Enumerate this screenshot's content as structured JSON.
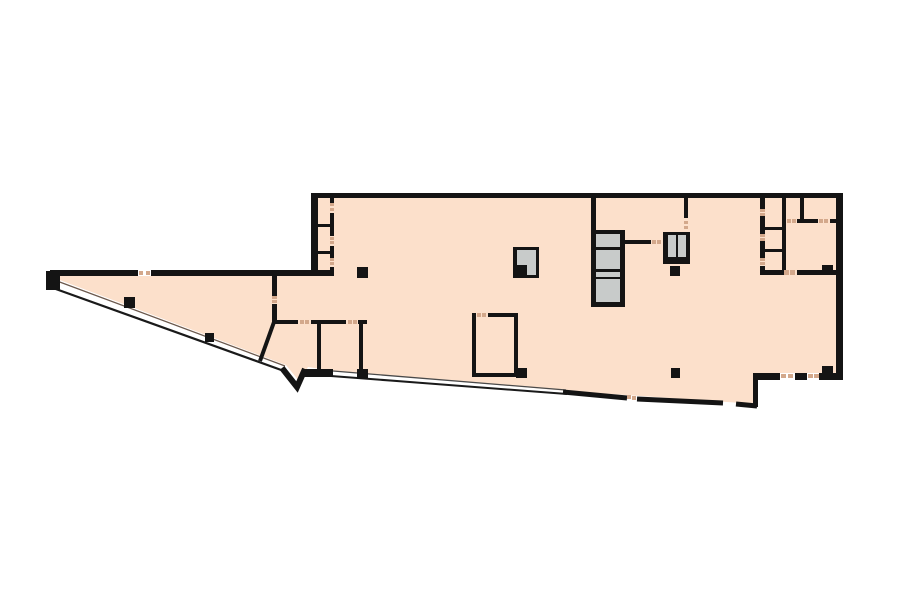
{
  "plan": {
    "view": {
      "w": 900,
      "h": 604,
      "bg": "#ffffff"
    },
    "palette": {
      "floor": "#fce0cb",
      "wall": "#141414",
      "shaft": "#c8cbca",
      "white": "#ffffff",
      "tick": "#d3a88b",
      "inner": "#6b584c",
      "edge": "#1a1a1a",
      "thin": "#4a4a4a"
    },
    "floor_outline": [
      [
        52,
        271
      ],
      [
        311,
        271
      ],
      [
        311,
        195
      ],
      [
        843,
        195
      ],
      [
        843,
        379
      ],
      [
        756,
        379
      ],
      [
        756,
        404
      ],
      [
        568,
        391
      ],
      [
        334,
        371
      ],
      [
        308,
        367
      ],
      [
        299,
        381
      ],
      [
        286,
        365
      ],
      [
        57,
        279
      ]
    ],
    "strokes": [
      {
        "n": "wedge-inner-line",
        "c": "inner",
        "w": 1.3,
        "pts": [
          [
            57,
            281
          ],
          [
            285,
            366
          ]
        ]
      },
      {
        "n": "wedge-outer-wall-line",
        "c": "edge",
        "w": 2.2,
        "pts": [
          [
            53,
            288
          ],
          [
            284,
            371
          ]
        ]
      },
      {
        "n": "bottom-inner-line",
        "c": "thin",
        "w": 1.3,
        "pts": [
          [
            333,
            371
          ],
          [
            566,
            390
          ]
        ]
      },
      {
        "n": "bottom-outer-wall-line",
        "c": "edge",
        "w": 2.0,
        "pts": [
          [
            331,
            376
          ],
          [
            567,
            394
          ]
        ]
      },
      {
        "n": "bottom-notch-wall",
        "c": "wall",
        "w": 6.0,
        "pts": [
          [
            282,
            368
          ],
          [
            297,
            387
          ],
          [
            305,
            369
          ]
        ]
      },
      {
        "n": "bottom-thick-wall-a",
        "c": "wall",
        "w": 5.0,
        "pts": [
          [
            563,
            392
          ],
          [
            627,
            398
          ]
        ]
      },
      {
        "n": "bottom-thick-wall-b",
        "c": "wall",
        "w": 5.0,
        "pts": [
          [
            637,
            399
          ],
          [
            723,
            403
          ]
        ]
      },
      {
        "n": "bottom-thick-wall-c",
        "c": "wall",
        "w": 5.0,
        "pts": [
          [
            736,
            404
          ],
          [
            757,
            406
          ]
        ]
      },
      {
        "n": "interior-diagonal-wall",
        "c": "wall",
        "w": 4.0,
        "pts": [
          [
            274,
            322
          ],
          [
            260,
            361
          ]
        ]
      }
    ],
    "rects": [
      {
        "n": "top-outer-wall",
        "c": "wall",
        "x": 311,
        "y": 193,
        "w": 532,
        "h": 5
      },
      {
        "n": "left-outer-wall",
        "c": "wall",
        "x": 311,
        "y": 193,
        "w": 7,
        "h": 83
      },
      {
        "n": "right-outer-wall",
        "c": "wall",
        "x": 836,
        "y": 193,
        "w": 7,
        "h": 187
      },
      {
        "n": "wedge-top-wall-a",
        "c": "wall",
        "x": 50,
        "y": 270,
        "w": 88,
        "h": 6
      },
      {
        "n": "wedge-top-wall-b",
        "c": "wall",
        "x": 151,
        "y": 270,
        "w": 183,
        "h": 6
      },
      {
        "n": "wedge-tip-corner",
        "c": "wall",
        "x": 46,
        "y": 271,
        "w": 14,
        "h": 19
      },
      {
        "n": "closet-wall-a",
        "c": "wall",
        "x": 330,
        "y": 198,
        "w": 4,
        "h": 5
      },
      {
        "n": "closet-wall-b",
        "c": "wall",
        "x": 330,
        "y": 213,
        "w": 4,
        "h": 23
      },
      {
        "n": "closet-wall-c",
        "c": "wall",
        "x": 330,
        "y": 246,
        "w": 4,
        "h": 12
      },
      {
        "n": "closet-wall-d",
        "c": "wall",
        "x": 330,
        "y": 267,
        "w": 4,
        "h": 4
      },
      {
        "n": "closet-divider-1",
        "c": "wall",
        "x": 315,
        "y": 224,
        "w": 19,
        "h": 3
      },
      {
        "n": "closet-divider-2",
        "c": "wall",
        "x": 315,
        "y": 251,
        "w": 19,
        "h": 3
      },
      {
        "n": "wedge-vertical-wall-a",
        "c": "wall",
        "x": 272,
        "y": 274,
        "w": 5,
        "h": 22
      },
      {
        "n": "wedge-vertical-wall-b",
        "c": "wall",
        "x": 272,
        "y": 304,
        "w": 5,
        "h": 18
      },
      {
        "n": "strip-wall-a",
        "c": "wall",
        "x": 272,
        "y": 320,
        "w": 26,
        "h": 4
      },
      {
        "n": "strip-wall-b",
        "c": "wall",
        "x": 311,
        "y": 320,
        "w": 35,
        "h": 4
      },
      {
        "n": "strip-wall-c",
        "c": "wall",
        "x": 358,
        "y": 320,
        "w": 9,
        "h": 4
      },
      {
        "n": "bottomleft-room-left-wall",
        "c": "wall",
        "x": 317,
        "y": 324,
        "w": 4,
        "h": 47
      },
      {
        "n": "bottomleft-room-right-wall",
        "c": "wall",
        "x": 359,
        "y": 324,
        "w": 4,
        "h": 46
      },
      {
        "n": "bottomleft-thick-bar",
        "c": "wall",
        "x": 303,
        "y": 369,
        "w": 30,
        "h": 8
      },
      {
        "n": "middleroom-top-wall-a",
        "c": "wall",
        "x": 472,
        "y": 313,
        "w": 4,
        "h": 4
      },
      {
        "n": "middleroom-top-wall-b",
        "c": "wall",
        "x": 488,
        "y": 313,
        "w": 30,
        "h": 4
      },
      {
        "n": "middleroom-left-wall",
        "c": "wall",
        "x": 472,
        "y": 313,
        "w": 4,
        "h": 64
      },
      {
        "n": "middleroom-right-wall",
        "c": "wall",
        "x": 514,
        "y": 313,
        "w": 4,
        "h": 64
      },
      {
        "n": "middleroom-bottom-wall",
        "c": "wall",
        "x": 472,
        "y": 373,
        "w": 46,
        "h": 4
      },
      {
        "n": "bank-left-wall-upper",
        "c": "wall",
        "x": 591,
        "y": 198,
        "w": 5,
        "h": 32
      },
      {
        "n": "bank-link-wall",
        "c": "wall",
        "x": 625,
        "y": 240,
        "w": 26,
        "h": 4
      },
      {
        "n": "stair-upper-wall",
        "c": "wall",
        "x": 684,
        "y": 198,
        "w": 4,
        "h": 20
      },
      {
        "n": "tr-vert760-wall-a",
        "c": "wall",
        "x": 760,
        "y": 198,
        "w": 5,
        "h": 11
      },
      {
        "n": "tr-vert760-wall-b",
        "c": "wall",
        "x": 760,
        "y": 216,
        "w": 5,
        "h": 18
      },
      {
        "n": "tr-vert760-wall-c",
        "c": "wall",
        "x": 760,
        "y": 241,
        "w": 5,
        "h": 17
      },
      {
        "n": "tr-vert760-wall-d",
        "c": "wall",
        "x": 760,
        "y": 266,
        "w": 5,
        "h": 6
      },
      {
        "n": "tr-divider-1",
        "c": "wall",
        "x": 760,
        "y": 227,
        "w": 22,
        "h": 3
      },
      {
        "n": "tr-divider-2",
        "c": "wall",
        "x": 760,
        "y": 249,
        "w": 22,
        "h": 3
      },
      {
        "n": "tr-vert782-wall",
        "c": "wall",
        "x": 782,
        "y": 198,
        "w": 4,
        "h": 77
      },
      {
        "n": "tr-vert800-wall",
        "c": "wall",
        "x": 800,
        "y": 198,
        "w": 4,
        "h": 25
      },
      {
        "n": "tr-horiz219-wall-a",
        "c": "wall",
        "x": 797,
        "y": 219,
        "w": 21,
        "h": 4
      },
      {
        "n": "tr-horiz219-wall-b",
        "c": "wall",
        "x": 830,
        "y": 219,
        "w": 6,
        "h": 4
      },
      {
        "n": "tr-bottom-wall-a",
        "c": "wall",
        "x": 760,
        "y": 270,
        "w": 23,
        "h": 5
      },
      {
        "n": "tr-bottom-wall-b",
        "c": "wall",
        "x": 797,
        "y": 270,
        "w": 39,
        "h": 5
      },
      {
        "n": "br-bottom-wall-a",
        "c": "wall",
        "x": 753,
        "y": 373,
        "w": 27,
        "h": 7
      },
      {
        "n": "br-bottom-wall-b",
        "c": "wall",
        "x": 795,
        "y": 373,
        "w": 12,
        "h": 7
      },
      {
        "n": "br-bottom-wall-c",
        "c": "wall",
        "x": 819,
        "y": 373,
        "w": 24,
        "h": 7
      },
      {
        "n": "br-step-wall",
        "c": "wall",
        "x": 753,
        "y": 373,
        "w": 5,
        "h": 34
      },
      {
        "n": "wedge-door-gap",
        "c": "white",
        "x": 138,
        "y": 269,
        "w": 13,
        "h": 7
      },
      {
        "n": "br-door-gap-1",
        "c": "white",
        "x": 780,
        "y": 373,
        "w": 15,
        "h": 7
      },
      {
        "n": "br-door-gap-2",
        "c": "white",
        "x": 807,
        "y": 373,
        "w": 12,
        "h": 7
      },
      {
        "n": "elevator-bank-box",
        "c": "wall",
        "x": 591,
        "y": 230,
        "w": 34,
        "h": 77
      },
      {
        "n": "elevator-cell-1",
        "c": "shaft",
        "x": 596,
        "y": 234,
        "w": 24,
        "h": 13
      },
      {
        "n": "elevator-cell-2",
        "c": "shaft",
        "x": 596,
        "y": 250,
        "w": 24,
        "h": 19
      },
      {
        "n": "elevator-cell-3",
        "c": "shaft",
        "x": 596,
        "y": 272,
        "w": 24,
        "h": 5
      },
      {
        "n": "elevator-cell-4",
        "c": "shaft",
        "x": 596,
        "y": 279,
        "w": 24,
        "h": 23
      },
      {
        "n": "stair-box",
        "c": "wall",
        "x": 663,
        "y": 232,
        "w": 27,
        "h": 32
      },
      {
        "n": "stair-cell-1",
        "c": "shaft",
        "x": 668,
        "y": 235,
        "w": 8,
        "h": 22
      },
      {
        "n": "stair-cell-2",
        "c": "shaft",
        "x": 678,
        "y": 235,
        "w": 8,
        "h": 22
      },
      {
        "n": "service-shaft-box",
        "c": "wall",
        "x": 513,
        "y": 247,
        "w": 26,
        "h": 31
      },
      {
        "n": "service-shaft-gray",
        "c": "shaft",
        "x": 517,
        "y": 250,
        "w": 19,
        "h": 25
      },
      {
        "n": "service-shaft-notch",
        "c": "wall",
        "x": 516,
        "y": 265,
        "w": 11,
        "h": 13
      },
      {
        "n": "column-1",
        "c": "wall",
        "x": 357,
        "y": 267,
        "w": 11,
        "h": 11
      },
      {
        "n": "column-2",
        "c": "wall",
        "x": 670,
        "y": 266,
        "w": 10,
        "h": 10
      },
      {
        "n": "column-3",
        "c": "wall",
        "x": 124,
        "y": 297,
        "w": 11,
        "h": 11
      },
      {
        "n": "column-4",
        "c": "wall",
        "x": 205,
        "y": 333,
        "w": 9,
        "h": 9
      },
      {
        "n": "column-5",
        "c": "wall",
        "x": 516,
        "y": 368,
        "w": 11,
        "h": 10
      },
      {
        "n": "column-6",
        "c": "wall",
        "x": 357,
        "y": 369,
        "w": 11,
        "h": 10
      },
      {
        "n": "column-7",
        "c": "wall",
        "x": 671,
        "y": 368,
        "w": 9,
        "h": 10
      },
      {
        "n": "column-8",
        "c": "wall",
        "x": 822,
        "y": 265,
        "w": 11,
        "h": 10
      },
      {
        "n": "column-9",
        "c": "wall",
        "x": 822,
        "y": 366,
        "w": 11,
        "h": 8
      },
      {
        "n": "tick",
        "c": "tick",
        "x": 139,
        "y": 271,
        "w": 4,
        "h": 4
      },
      {
        "n": "tick",
        "c": "tick",
        "x": 146,
        "y": 271,
        "w": 4,
        "h": 4
      },
      {
        "n": "tick",
        "c": "tick",
        "x": 330,
        "y": 203,
        "w": 4,
        "h": 3
      },
      {
        "n": "tick",
        "c": "tick",
        "x": 330,
        "y": 208,
        "w": 4,
        "h": 3
      },
      {
        "n": "tick",
        "c": "tick",
        "x": 330,
        "y": 237,
        "w": 4,
        "h": 3
      },
      {
        "n": "tick",
        "c": "tick",
        "x": 330,
        "y": 241,
        "w": 4,
        "h": 3
      },
      {
        "n": "tick",
        "c": "tick",
        "x": 330,
        "y": 258,
        "w": 4,
        "h": 3
      },
      {
        "n": "tick",
        "c": "tick",
        "x": 330,
        "y": 262,
        "w": 4,
        "h": 3
      },
      {
        "n": "tick",
        "c": "tick",
        "x": 272,
        "y": 296,
        "w": 5,
        "h": 3
      },
      {
        "n": "tick",
        "c": "tick",
        "x": 272,
        "y": 300,
        "w": 5,
        "h": 3
      },
      {
        "n": "tick",
        "c": "tick",
        "x": 300,
        "y": 320,
        "w": 4,
        "h": 4
      },
      {
        "n": "tick",
        "c": "tick",
        "x": 305,
        "y": 320,
        "w": 4,
        "h": 4
      },
      {
        "n": "tick",
        "c": "tick",
        "x": 348,
        "y": 320,
        "w": 4,
        "h": 4
      },
      {
        "n": "tick",
        "c": "tick",
        "x": 353,
        "y": 320,
        "w": 4,
        "h": 4
      },
      {
        "n": "tick",
        "c": "tick",
        "x": 477,
        "y": 313,
        "w": 4,
        "h": 4
      },
      {
        "n": "tick",
        "c": "tick",
        "x": 482,
        "y": 313,
        "w": 4,
        "h": 4
      },
      {
        "n": "tick",
        "c": "tick",
        "x": 652,
        "y": 240,
        "w": 4,
        "h": 4
      },
      {
        "n": "tick",
        "c": "tick",
        "x": 657,
        "y": 240,
        "w": 4,
        "h": 4
      },
      {
        "n": "tick",
        "c": "tick",
        "x": 684,
        "y": 221,
        "w": 4,
        "h": 3
      },
      {
        "n": "tick",
        "c": "tick",
        "x": 684,
        "y": 226,
        "w": 4,
        "h": 3
      },
      {
        "n": "tick",
        "c": "tick",
        "x": 760,
        "y": 209,
        "w": 5,
        "h": 3
      },
      {
        "n": "tick",
        "c": "tick",
        "x": 760,
        "y": 213,
        "w": 5,
        "h": 3
      },
      {
        "n": "tick",
        "c": "tick",
        "x": 760,
        "y": 234,
        "w": 5,
        "h": 3
      },
      {
        "n": "tick",
        "c": "tick",
        "x": 760,
        "y": 238,
        "w": 5,
        "h": 3
      },
      {
        "n": "tick",
        "c": "tick",
        "x": 760,
        "y": 258,
        "w": 5,
        "h": 3
      },
      {
        "n": "tick",
        "c": "tick",
        "x": 760,
        "y": 262,
        "w": 5,
        "h": 3
      },
      {
        "n": "tick",
        "c": "tick",
        "x": 787,
        "y": 219,
        "w": 4,
        "h": 4
      },
      {
        "n": "tick",
        "c": "tick",
        "x": 792,
        "y": 219,
        "w": 4,
        "h": 4
      },
      {
        "n": "tick",
        "c": "tick",
        "x": 819,
        "y": 219,
        "w": 4,
        "h": 4
      },
      {
        "n": "tick",
        "c": "tick",
        "x": 824,
        "y": 219,
        "w": 4,
        "h": 4
      },
      {
        "n": "tick",
        "c": "tick",
        "x": 784,
        "y": 270,
        "w": 5,
        "h": 5
      },
      {
        "n": "tick",
        "c": "tick",
        "x": 790,
        "y": 270,
        "w": 5,
        "h": 5
      },
      {
        "n": "tick",
        "c": "tick",
        "x": 781,
        "y": 374,
        "w": 5,
        "h": 4
      },
      {
        "n": "tick",
        "c": "tick",
        "x": 788,
        "y": 374,
        "w": 5,
        "h": 4
      },
      {
        "n": "tick",
        "c": "tick",
        "x": 808,
        "y": 374,
        "w": 5,
        "h": 4
      },
      {
        "n": "tick",
        "c": "tick",
        "x": 814,
        "y": 374,
        "w": 5,
        "h": 4
      },
      {
        "n": "tick",
        "c": "tick",
        "x": 627,
        "y": 395,
        "w": 4,
        "h": 4
      },
      {
        "n": "tick",
        "c": "tick",
        "x": 632,
        "y": 396,
        "w": 4,
        "h": 4
      }
    ]
  }
}
